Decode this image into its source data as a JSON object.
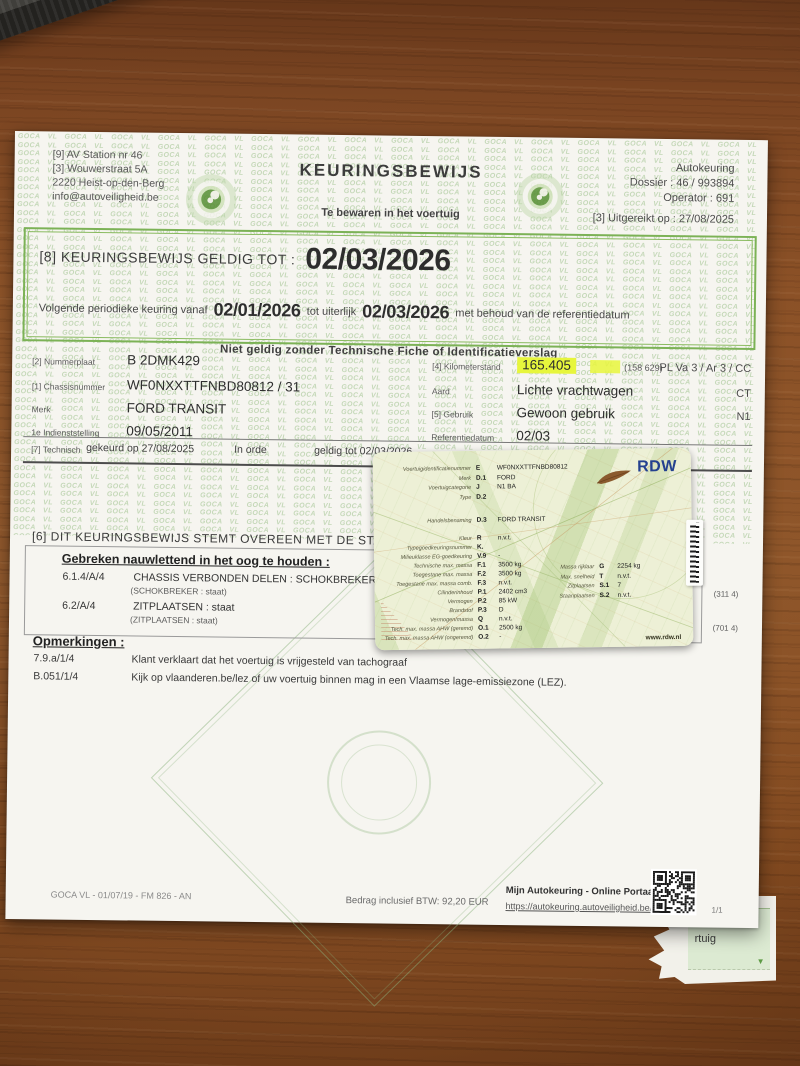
{
  "watermark": {
    "text": "GOCA VL"
  },
  "icons": {
    "torn_arrow": "▼",
    "goca_eye": "eye-logo",
    "qr": "qr-code",
    "feather": "bird-feather",
    "barcode": "barcode-sticker"
  },
  "colors": {
    "accent_green": "#79b256",
    "highlight_marker": "#e7f63c",
    "rdw_blue": "#24418f",
    "card_bg": "#edf0d6",
    "paper": "#f6f5f0",
    "wood": "#8a5026"
  },
  "certificate": {
    "issuer": {
      "line1": "[9] AV Station nr 46",
      "line2": "[3] Wouwerstraat 5A",
      "line3": "2220 Heist-op-den-Berg",
      "line4": "info@autoveiligheid.be"
    },
    "title": "KEURINGSBEWIJS",
    "subtitle": "Te bewaren in het voertuig",
    "office": {
      "name": "Autokeuring",
      "dossier": "Dossier : 46 / 993894",
      "operator": "Operator : 691",
      "issued": "[3] Uitgereikt op : 27/08/2025"
    },
    "validity": {
      "label": "[8] KEURINGSBEWIJS GELDIG TOT :",
      "date": "02/03/2026",
      "next_pre": "Volgende periodieke keuring vanaf",
      "next_from": "02/01/2026",
      "next_mid": "tot uiterlijk",
      "next_until": "02/03/2026",
      "next_post": "met behoud van de referentiedatum"
    },
    "notice": "Niet geldig zonder Technische Fiche of Identificatieverslag",
    "vehicle_rows": [
      {
        "label": "[2] Nummerplaat",
        "value": "B 2DMK429",
        "label2": "[4] Kilometerstand",
        "value2": "165.405",
        "value2_note": "(158 629)",
        "right": "PL Va 3 / Ar 3 / CC"
      },
      {
        "label": "[1] Chassisnummer",
        "value": "WF0NXXTTFNBD80812 / 31",
        "label2": "Aard",
        "value2": "Lichte vrachtwagen",
        "value2_note": "",
        "right": "CT"
      },
      {
        "label": "Merk",
        "value": "FORD TRANSIT",
        "label2": "[5] Gebruik",
        "value2": "Gewoon gebruik",
        "value2_note": "",
        "right": "N1"
      },
      {
        "label": "1e Indienststelling",
        "value": "09/05/2011",
        "label2": "Referentiedatum",
        "value2": "02/03",
        "value2_note": "",
        "right": ""
      }
    ],
    "inspection": {
      "label": "[7] Technisch",
      "checked_on": "gekeurd op 27/08/2025",
      "result": "In orde",
      "valid_until": "geldig tot 02/03/2026"
    },
    "statement": "[6] DIT KEURINGSBEWIJS STEMT OVEREEN MET DE STAAT VAN",
    "defects": {
      "heading": "Gebreken nauwlettend in het oog te houden :",
      "items": [
        {
          "code": "6.1.4/A/4",
          "text": "CHASSIS VERBONDEN DELEN : SCHOKBREKER : staat",
          "sub": "(SCHOKBREKER : staat)"
        },
        {
          "code": "6.2/A/4",
          "text": "ZITPLAATSEN : staat",
          "sub": "(ZITPLAATSEN : staat)"
        }
      ],
      "ref1": "(311 4)",
      "ref2": "(701 4)"
    },
    "remarks": {
      "heading": "Opmerkingen :",
      "items": [
        {
          "code": "7.9.a/1/4",
          "text": "Klant verklaart dat het voertuig is vrijgesteld van tachograaf"
        },
        {
          "code": "B.051/1/4",
          "text": "Kijk op vlaanderen.be/lez of uw voertuig binnen mag in een Vlaamse lage-emissiezone (LEZ)."
        }
      ]
    },
    "footer": {
      "form_ref": "GOCA VL - 01/07/19 - FM 826 - AN",
      "amount": "Bedrag inclusief BTW: 92,20 EUR",
      "portal_title": "Mijn Autokeuring - Online Portaal",
      "portal_url": "https://autokeuring.autoveiligheid.be/",
      "page": "1/1"
    }
  },
  "rdw_card": {
    "brand": "RDW",
    "website": "www.rdw.nl",
    "id_rows": [
      {
        "label": "Voertuigidentificatienummer",
        "code": "E",
        "value": "WF0NXXTTFNBD80812"
      },
      {
        "label": "Merk",
        "code": "D.1",
        "value": "FORD"
      },
      {
        "label": "Voertuigcategorie",
        "code": "J",
        "value": "N1 BA"
      },
      {
        "label": "Type",
        "code": "D.2",
        "value": ""
      }
    ],
    "name_row": {
      "label": "Handelsbenaming",
      "code": "D.3",
      "value": "FORD TRANSIT"
    },
    "spec_rows": [
      {
        "label": "Kleur",
        "code": "R",
        "value": "n.v.t."
      },
      {
        "label": "Typegoedkeuringsnummer",
        "code": "K.",
        "value": ""
      },
      {
        "label": "Milieuklasse EG-goedkeuring",
        "code": "V.9",
        "value": "-"
      },
      {
        "label": "Technische max. massa",
        "code": "F.1",
        "value": "3500 kg"
      },
      {
        "label": "Toegestane max. massa",
        "code": "F.2",
        "value": "3500 kg"
      },
      {
        "label": "Toegestane max. massa comb.",
        "code": "F.3",
        "value": "n.v.t."
      },
      {
        "label": "Cilinderinhoud",
        "code": "P.1",
        "value": "2402 cm3"
      },
      {
        "label": "Vermogen",
        "code": "P.2",
        "value": "85 kW"
      },
      {
        "label": "Brandstof",
        "code": "P.3",
        "value": "D"
      },
      {
        "label": "Vermogen/massa",
        "code": "Q",
        "value": "n.v.t."
      },
      {
        "label": "Tech. max. massa AHW (geremd)",
        "code": "O.1",
        "value": "2500 kg"
      },
      {
        "label": "Tech. max. massa AHW (ongeremd)",
        "code": "O.2",
        "value": "-"
      }
    ],
    "side_rows": [
      {
        "label": "Massa rijklaar",
        "code": "G",
        "value": "2254 kg"
      },
      {
        "label": "Max. snelheid",
        "code": "T",
        "value": "n.v.t."
      },
      {
        "label": "Zitplaatsen",
        "code": "S.1",
        "value": "7"
      },
      {
        "label": "Staanplaatsen",
        "code": "S.2",
        "value": "n.v.t."
      }
    ]
  },
  "torn_fragment": {
    "line1": "n en",
    "line2": "rtuig"
  }
}
